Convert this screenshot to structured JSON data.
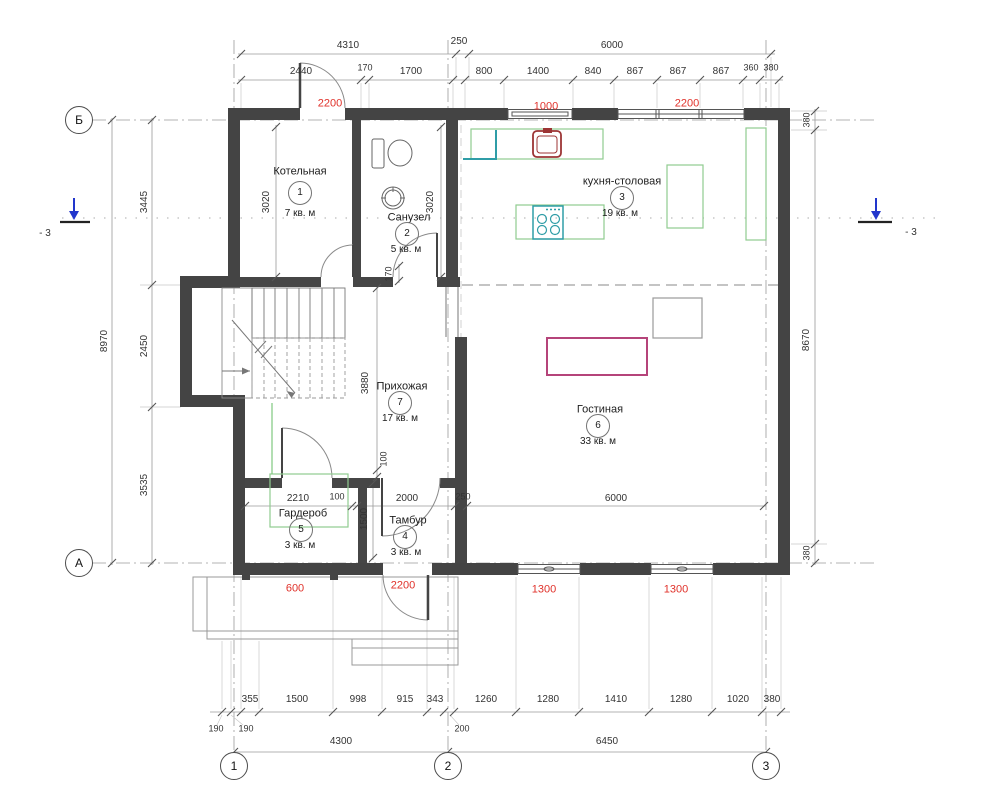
{
  "axes": {
    "row_b": "Б",
    "row_a": "А",
    "col_1": "1",
    "col_2": "2",
    "col_3": "3"
  },
  "section": {
    "label": "- 3"
  },
  "rooms": [
    {
      "number": "1",
      "name": "Котельная",
      "area": "7 кв. м"
    },
    {
      "number": "2",
      "name": "Санузел",
      "area": "5 кв. м"
    },
    {
      "number": "3",
      "name": "кухня-столовая",
      "area": "19 кв. м"
    },
    {
      "number": "4",
      "name": "Тамбур",
      "area": "3 кв. м"
    },
    {
      "number": "5",
      "name": "Гардероб",
      "area": "3 кв. м"
    },
    {
      "number": "6",
      "name": "Гостиная",
      "area": "33 кв. м"
    },
    {
      "number": "7",
      "name": "Прихожая",
      "area": "17 кв. м"
    }
  ],
  "dims": {
    "top1": [
      "4310",
      "250",
      "6000"
    ],
    "top2": [
      "2440",
      "170",
      "1700",
      "800",
      "1400",
      "840",
      "867",
      "867",
      "867",
      "360",
      "380"
    ],
    "top_red": [
      "2200",
      "1000",
      "2200"
    ],
    "left_total": "8970",
    "left": [
      "3445",
      "2450",
      "3535"
    ],
    "right": [
      "380",
      "8670",
      "380"
    ],
    "inner": {
      "k3020": "3020",
      "s3020": "3020",
      "d170": "170",
      "h3880": "3880",
      "h100": "100",
      "g2210": "2210",
      "g100": "100",
      "t2000": "2000",
      "w250": "250",
      "t1500": "1500",
      "l6000": "6000"
    },
    "bot_red": [
      "600",
      "2200",
      "1300",
      "1300"
    ],
    "bot1": [
      "355",
      "1500",
      "998",
      "915",
      "343",
      "1260",
      "1280",
      "1410",
      "1280",
      "1020",
      "380"
    ],
    "bot_small": [
      "190",
      "190",
      "200"
    ],
    "bot2": [
      "4300",
      "6450"
    ]
  },
  "colors": {
    "dim_red": "#e0312a",
    "furniture_green": "#90cc90",
    "fixture_teal": "#2f9da7",
    "sink_red": "#9c3434",
    "table_pink": "#b5447a",
    "section_blue": "#2236cc",
    "wall": "#444444"
  }
}
